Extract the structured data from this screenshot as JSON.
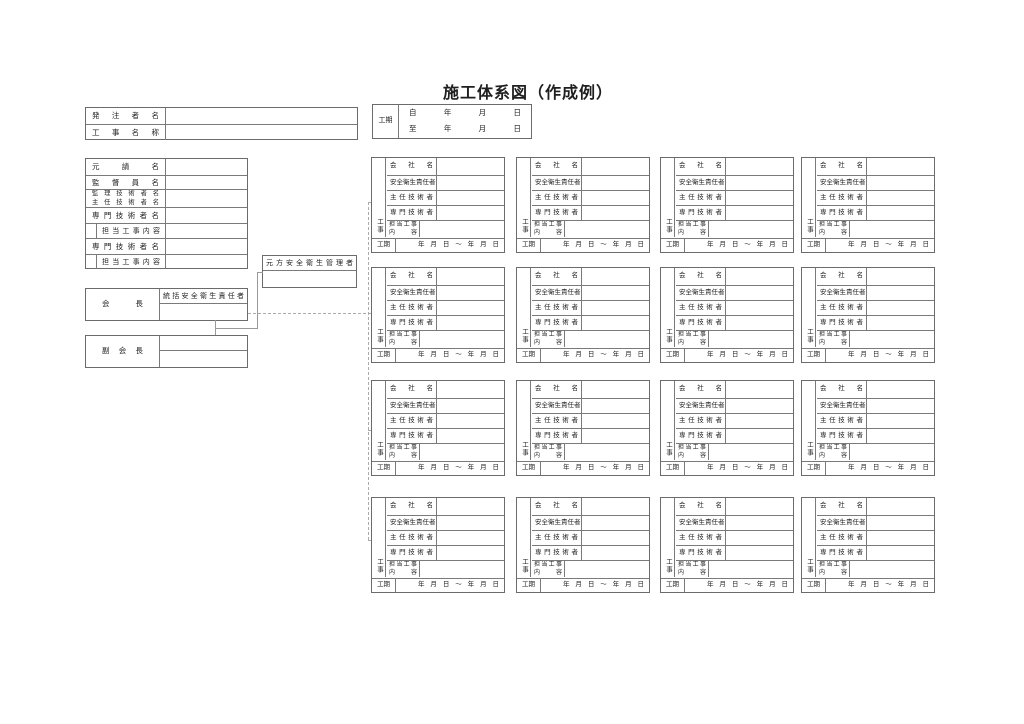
{
  "title": "施工体系図（作成例）",
  "colors": {
    "border": "#6b6b6b",
    "connector_solid": "#999999",
    "connector_dashed": "#ababab",
    "text": "#1f1f1f",
    "background": "#ffffff"
  },
  "owner_table": {
    "rows": [
      {
        "label": "発注者名",
        "value": ""
      },
      {
        "label": "工事名称",
        "value": ""
      }
    ]
  },
  "period_table": {
    "label": "工期",
    "line_from": "自 年 月 日",
    "line_to": "至 年 月 日"
  },
  "prime_table": {
    "rows": [
      {
        "label": "元請名"
      },
      {
        "label": "監督員名"
      },
      {
        "label": "監理技術者名",
        "label2": "主任技術者名"
      },
      {
        "label": "専門技術者名"
      },
      {
        "label": "担当工事内容",
        "indent": true
      },
      {
        "label": "専門技術者名"
      },
      {
        "label": "担当工事内容",
        "indent": true
      }
    ]
  },
  "chairman_box": {
    "label": "会長",
    "officer_label": "統括安全衛生責任者",
    "officer_value": ""
  },
  "vice_chairman_box": {
    "label": "副会長",
    "value_top": "",
    "value_bottom": ""
  },
  "principal_safety_manager_box": {
    "label": "元方安全衛生管理者",
    "value": ""
  },
  "subcontractor_box": {
    "vertical_label": "工事",
    "row_labels": [
      "会社名",
      "安全衛生責任者",
      "主任技術者",
      "専門技術者",
      "担当工事内容"
    ],
    "row_values": [
      "",
      "",
      "",
      "",
      ""
    ],
    "period_label": "工期",
    "period_value": "年 月 日 ～ 年 月 日"
  },
  "grid": {
    "rows": 4,
    "cols": 4
  }
}
